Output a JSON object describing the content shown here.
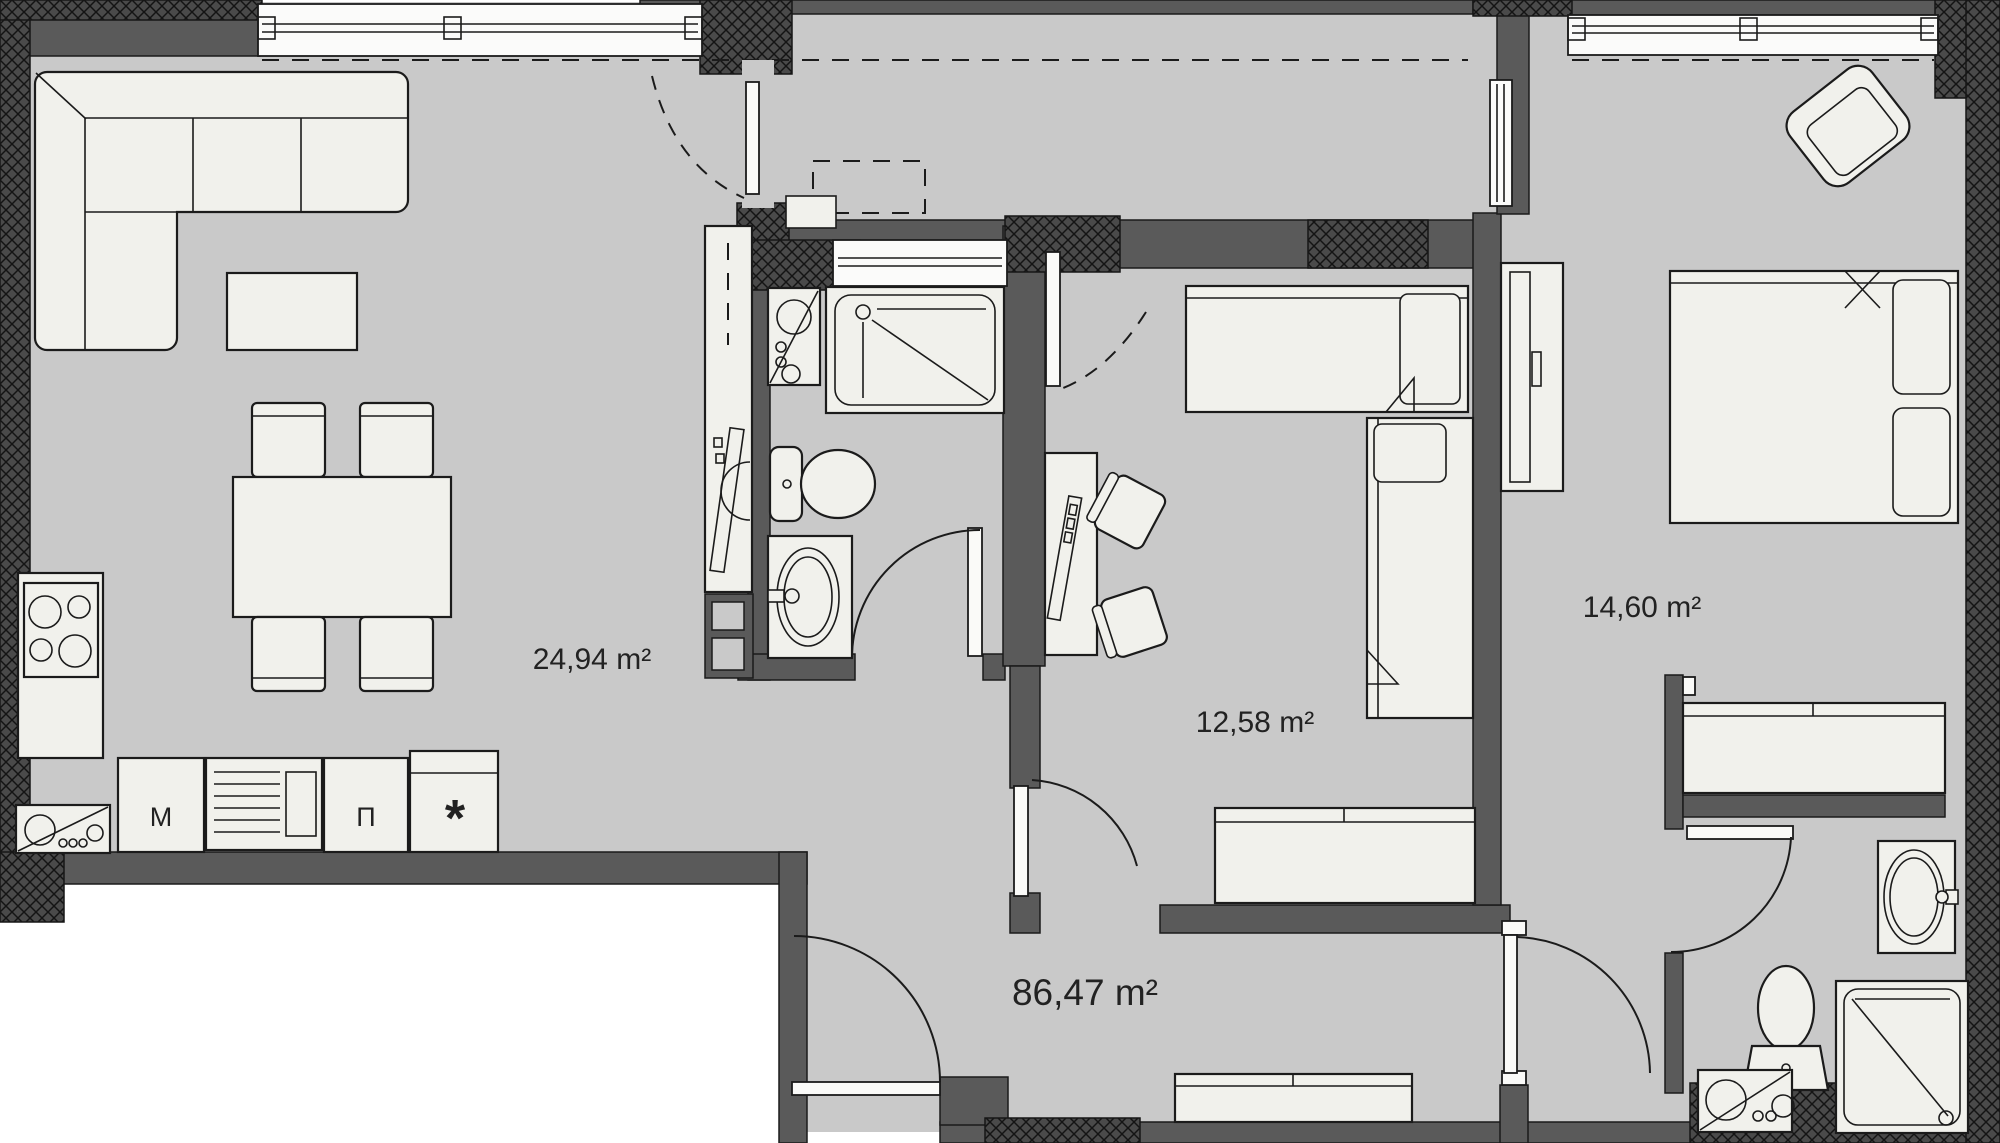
{
  "document": {
    "kind": "apartment-floor-plan"
  },
  "labels": {
    "living_area": "24,94 m²",
    "kids_room_area": "12,58 m²",
    "bedroom_area": "14,60 m²",
    "total_area": "86,47 m²"
  },
  "kitchen": {
    "cabinet_m": "М",
    "cabinet_p": "П",
    "stove_marker": "*"
  },
  "colors": {
    "floor": "#c9c9c9",
    "wall": "#5a5a5a",
    "wall_hatched": "#4a4a4a",
    "top_edge_strip": "#6f6f6f",
    "furniture": "#f1f1ec",
    "outline": "#1b1b1b",
    "background": "#ffffff",
    "text": "#222222"
  }
}
